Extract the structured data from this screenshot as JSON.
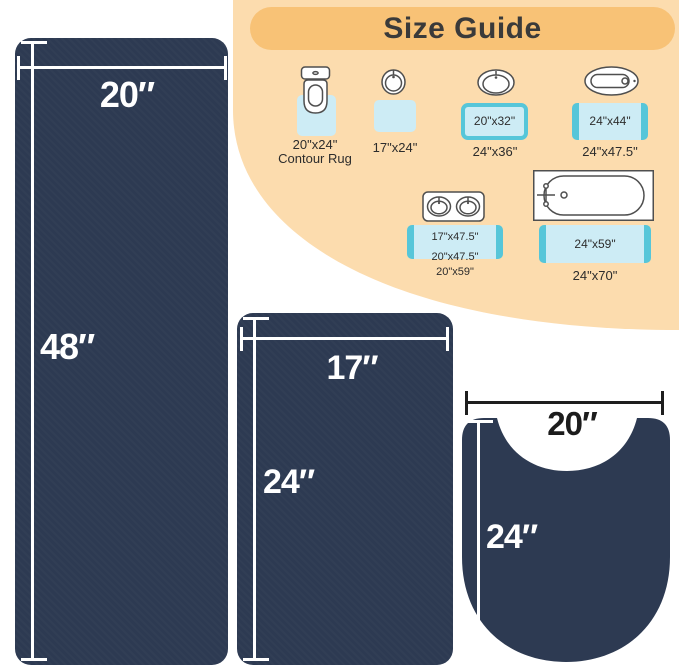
{
  "size_guide": {
    "title": "Size Guide",
    "items": [
      {
        "icon": "toilet",
        "label": "20\"x24\"",
        "sublabel": "Contour Rug"
      },
      {
        "icon": "round-sink",
        "label": "17\"x24\""
      },
      {
        "icon": "oval-sink",
        "rug_label": "20\"x32\"",
        "label": "24\"x36\""
      },
      {
        "icon": "small-tub",
        "rug_label": "24\"x44\"",
        "label": "24\"x47.5\""
      },
      {
        "icon": "double-sink",
        "rug_label": "17\"x47.5\"",
        "rug_label_2": "20\"x47.5\"",
        "label": "20\"x59\""
      },
      {
        "icon": "bathtub",
        "rug_label": "24\"x59\"",
        "label": "24\"x70\""
      }
    ]
  },
  "rugs": {
    "runner": {
      "width_label": "20″",
      "height_label": "48″"
    },
    "medium": {
      "width_label": "17″",
      "height_label": "24″"
    },
    "contour": {
      "width_label": "20″",
      "height_label": "24″"
    }
  },
  "colors": {
    "navy_rug": "#2d3a52",
    "background_blob": "#fcdcae",
    "header_pill": "#f8c276",
    "guide_rug_fill": "#cdecf5",
    "guide_rug_edge": "#56c6d9",
    "title_text": "#3a3a3a"
  }
}
